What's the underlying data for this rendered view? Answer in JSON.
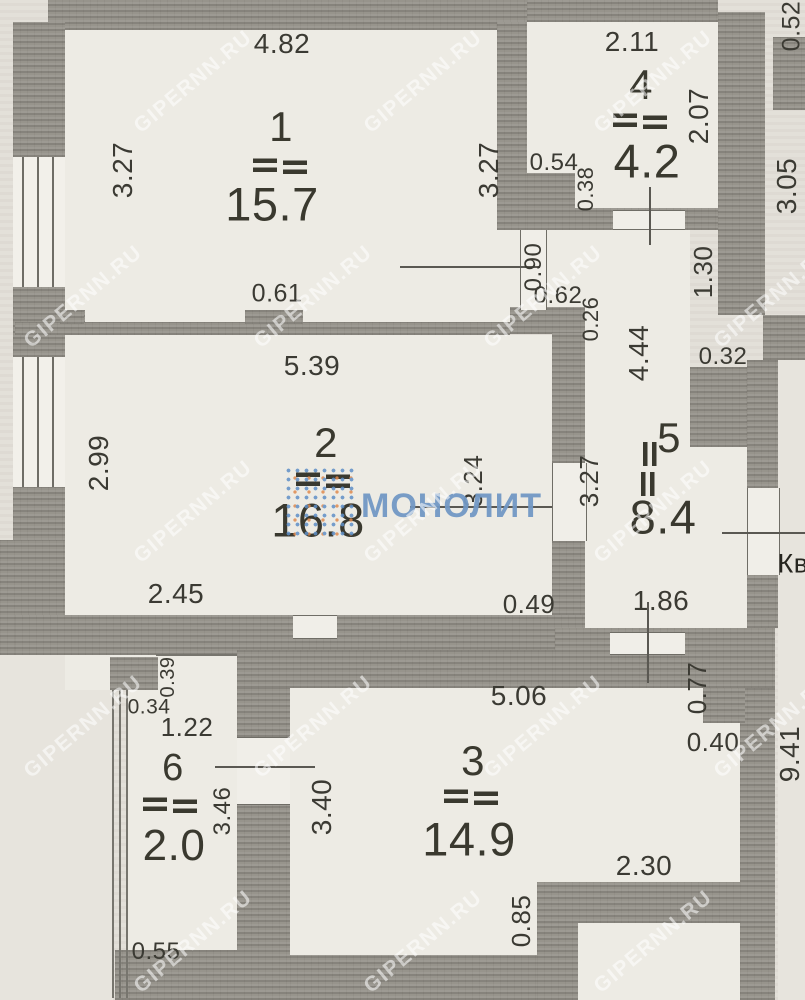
{
  "document": {
    "type": "apartment floor plan (scanned)",
    "side_text": "Кв",
    "watermark_site": "GIPERNN.RU",
    "watermark_brand": "МОНОЛИТ"
  },
  "colors": {
    "paper": "#e3e0d9",
    "room_fill": "#edebe4",
    "wall": "#97948c",
    "text": "#3b3a33",
    "watermark_site": "rgba(255,255,255,0.55)",
    "brand_blue": "#7298c4",
    "brand_dot_blue": "#5f8fc7",
    "brand_dot_orange": "#e08a4e"
  },
  "rooms": [
    {
      "number": "1",
      "area": "15.7",
      "dims": [
        "4.82",
        "3.27",
        "3.27",
        "0.61"
      ]
    },
    {
      "number": "2",
      "area": "16.8",
      "dims": [
        "5.39",
        "2.99",
        "3.24",
        "3.27",
        "2.45",
        "0.49"
      ]
    },
    {
      "number": "3",
      "area": "14.9",
      "dims": [
        "5.06",
        "3.40",
        "2.30",
        "0.85"
      ]
    },
    {
      "number": "4",
      "area": "4.2",
      "dims": [
        "2.11",
        "2.07",
        "0.54",
        "0.38"
      ]
    },
    {
      "number": "5",
      "area": "8.4",
      "dims": [
        "4.44",
        "0.32",
        "1.86"
      ]
    },
    {
      "number": "6",
      "area": "2.0",
      "dims": [
        "1.22",
        "0.34",
        "0.39",
        "3.46",
        "0.55"
      ]
    }
  ],
  "texts": [
    {
      "name": "dim-4.82",
      "text": "4.82",
      "x": 282,
      "y": 44,
      "size": 28,
      "rot": false
    },
    {
      "name": "dim-3.27-left",
      "text": "3.27",
      "x": 123,
      "y": 170,
      "size": 28,
      "rot": true
    },
    {
      "name": "dim-3.27-right",
      "text": "3.27",
      "x": 489,
      "y": 170,
      "size": 28,
      "rot": true
    },
    {
      "name": "dim-0.61",
      "text": "0.61",
      "x": 277,
      "y": 294,
      "size": 25,
      "rot": false
    },
    {
      "name": "dim-2.11",
      "text": "2.11",
      "x": 632,
      "y": 42,
      "size": 28,
      "rot": false
    },
    {
      "name": "dim-2.07",
      "text": "2.07",
      "x": 699,
      "y": 116,
      "size": 28,
      "rot": true
    },
    {
      "name": "dim-0.54",
      "text": "0.54",
      "x": 554,
      "y": 163,
      "size": 24,
      "rot": false
    },
    {
      "name": "dim-0.38",
      "text": "0.38",
      "x": 586,
      "y": 189,
      "size": 22,
      "rot": true
    },
    {
      "name": "dim-0.52",
      "text": "0.52",
      "x": 792,
      "y": 26,
      "size": 25,
      "rot": true
    },
    {
      "name": "dim-3.05",
      "text": "3.05",
      "x": 787,
      "y": 186,
      "size": 28,
      "rot": true
    },
    {
      "name": "dim-0.90",
      "text": "0.90",
      "x": 534,
      "y": 267,
      "size": 24,
      "rot": true
    },
    {
      "name": "dim-0.62",
      "text": "0.62",
      "x": 558,
      "y": 296,
      "size": 24,
      "rot": false
    },
    {
      "name": "dim-0.26",
      "text": "0.26",
      "x": 591,
      "y": 319,
      "size": 22,
      "rot": true
    },
    {
      "name": "dim-1.30",
      "text": "1.30",
      "x": 703,
      "y": 272,
      "size": 26,
      "rot": true
    },
    {
      "name": "dim-4.44",
      "text": "4.44",
      "x": 639,
      "y": 353,
      "size": 28,
      "rot": true
    },
    {
      "name": "dim-0.32",
      "text": "0.32",
      "x": 723,
      "y": 357,
      "size": 24,
      "rot": false
    },
    {
      "name": "dim-5.39",
      "text": "5.39",
      "x": 312,
      "y": 366,
      "size": 28,
      "rot": false
    },
    {
      "name": "dim-2.99",
      "text": "2.99",
      "x": 99,
      "y": 463,
      "size": 28,
      "rot": true
    },
    {
      "name": "dim-3.24",
      "text": "3.24",
      "x": 473,
      "y": 481,
      "size": 26,
      "rot": true
    },
    {
      "name": "dim-3.27-mid",
      "text": "3.27",
      "x": 589,
      "y": 481,
      "size": 26,
      "rot": true
    },
    {
      "name": "dim-2.45",
      "text": "2.45",
      "x": 176,
      "y": 594,
      "size": 28,
      "rot": false
    },
    {
      "name": "dim-0.49",
      "text": "0.49",
      "x": 529,
      "y": 604,
      "size": 26,
      "rot": false
    },
    {
      "name": "dim-1.86",
      "text": "1.86",
      "x": 661,
      "y": 601,
      "size": 28,
      "rot": false
    },
    {
      "name": "dim-0.77",
      "text": "0.77",
      "x": 697,
      "y": 688,
      "size": 26,
      "rot": true
    },
    {
      "name": "dim-0.40",
      "text": "0.40",
      "x": 713,
      "y": 742,
      "size": 26,
      "rot": false
    },
    {
      "name": "dim-9.41",
      "text": "9.41",
      "x": 790,
      "y": 754,
      "size": 28,
      "rot": true
    },
    {
      "name": "dim-5.06",
      "text": "5.06",
      "x": 519,
      "y": 696,
      "size": 28,
      "rot": false
    },
    {
      "name": "dim-3.40",
      "text": "3.40",
      "x": 322,
      "y": 807,
      "size": 28,
      "rot": true
    },
    {
      "name": "dim-2.30",
      "text": "2.30",
      "x": 644,
      "y": 866,
      "size": 28,
      "rot": false
    },
    {
      "name": "dim-0.85",
      "text": "0.85",
      "x": 521,
      "y": 921,
      "size": 26,
      "rot": true
    },
    {
      "name": "dim-0.39",
      "text": "0.39",
      "x": 168,
      "y": 677,
      "size": 20,
      "rot": true
    },
    {
      "name": "dim-0.34",
      "text": "0.34",
      "x": 149,
      "y": 707,
      "size": 21,
      "rot": false
    },
    {
      "name": "dim-1.22",
      "text": "1.22",
      "x": 187,
      "y": 727,
      "size": 26,
      "rot": false
    },
    {
      "name": "dim-3.46",
      "text": "3.46",
      "x": 223,
      "y": 811,
      "size": 24,
      "rot": true
    },
    {
      "name": "dim-0.55",
      "text": "0.55",
      "x": 156,
      "y": 952,
      "size": 24,
      "rot": false
    },
    {
      "name": "room-1-number",
      "text": "1",
      "x": 281,
      "y": 127,
      "size": 42,
      "rot": false,
      "cls": "room-number"
    },
    {
      "name": "room-1-area",
      "text": "15.7",
      "x": 272,
      "y": 204,
      "size": 47,
      "rot": false,
      "cls": "room-area"
    },
    {
      "name": "room-4-number",
      "text": "4",
      "x": 641,
      "y": 85,
      "size": 42,
      "rot": false,
      "cls": "room-number"
    },
    {
      "name": "room-4-area",
      "text": "4.2",
      "x": 647,
      "y": 161,
      "size": 47,
      "rot": false,
      "cls": "room-area"
    },
    {
      "name": "room-2-number",
      "text": "2",
      "x": 326,
      "y": 443,
      "size": 42,
      "rot": false,
      "cls": "room-number"
    },
    {
      "name": "room-2-area",
      "text": "16.8",
      "x": 318,
      "y": 520,
      "size": 47,
      "rot": false,
      "cls": "room-area"
    },
    {
      "name": "room-5-number",
      "text": "5",
      "x": 669,
      "y": 438,
      "size": 42,
      "rot": false,
      "cls": "room-number"
    },
    {
      "name": "room-5-area",
      "text": "8.4",
      "x": 663,
      "y": 517,
      "size": 47,
      "rot": false,
      "cls": "room-area"
    },
    {
      "name": "room-3-number",
      "text": "3",
      "x": 473,
      "y": 761,
      "size": 42,
      "rot": false,
      "cls": "room-number"
    },
    {
      "name": "room-3-area",
      "text": "14.9",
      "x": 469,
      "y": 839,
      "size": 47,
      "rot": false,
      "cls": "room-area"
    },
    {
      "name": "room-6-number",
      "text": "6",
      "x": 173,
      "y": 768,
      "size": 38,
      "rot": false,
      "cls": "room-number"
    },
    {
      "name": "room-6-area",
      "text": "2.0",
      "x": 174,
      "y": 846,
      "size": 44,
      "rot": false,
      "cls": "room-area"
    },
    {
      "name": "side-text-kv",
      "text": "Кв",
      "x": 793,
      "y": 564,
      "size": 27,
      "rot": false,
      "cls": "side-text"
    }
  ],
  "markers": [
    {
      "name": "room-1-marker",
      "x": 281,
      "y": 166,
      "rot": false
    },
    {
      "name": "room-4-marker",
      "x": 641,
      "y": 121,
      "rot": false
    },
    {
      "name": "room-2-marker",
      "x": 324,
      "y": 480,
      "rot": false
    },
    {
      "name": "room-5-marker",
      "x": 649,
      "y": 470,
      "rot": true
    },
    {
      "name": "room-3-marker",
      "x": 472,
      "y": 797,
      "rot": false
    },
    {
      "name": "room-6-marker",
      "x": 171,
      "y": 805,
      "rot": false
    }
  ]
}
